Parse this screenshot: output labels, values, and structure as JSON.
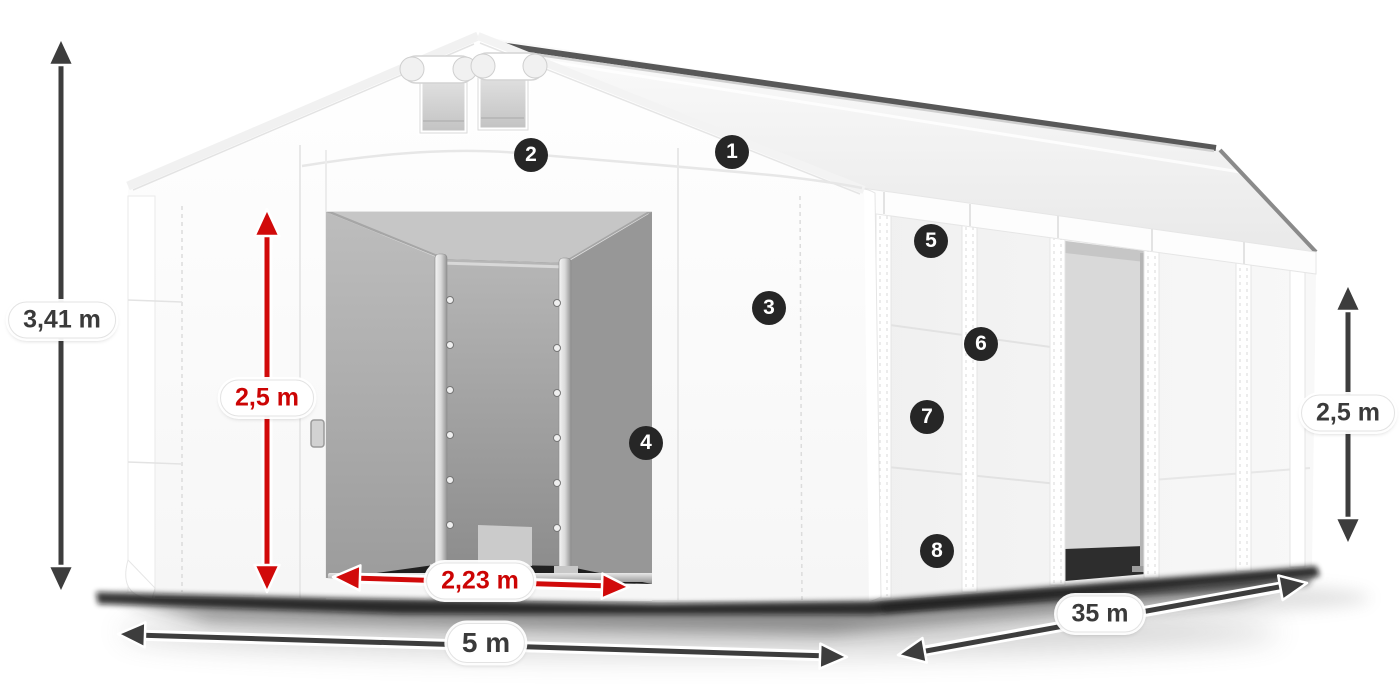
{
  "diagram": {
    "dimensions": {
      "total_height": "3,41 m",
      "door_height": "2,5 m",
      "door_width": "2,23 m",
      "width": "5 m",
      "length": "35 m",
      "side_height": "2,5 m"
    },
    "callouts": [
      {
        "number": "1"
      },
      {
        "number": "2"
      },
      {
        "number": "3"
      },
      {
        "number": "4"
      },
      {
        "number": "5"
      },
      {
        "number": "6"
      },
      {
        "number": "7"
      },
      {
        "number": "8"
      }
    ],
    "colors": {
      "accent_red": "#d10a0a",
      "arrow_dark": "#3d3d3d",
      "badge_bg": "#262626",
      "canvas_bg": "#ffffff"
    }
  }
}
